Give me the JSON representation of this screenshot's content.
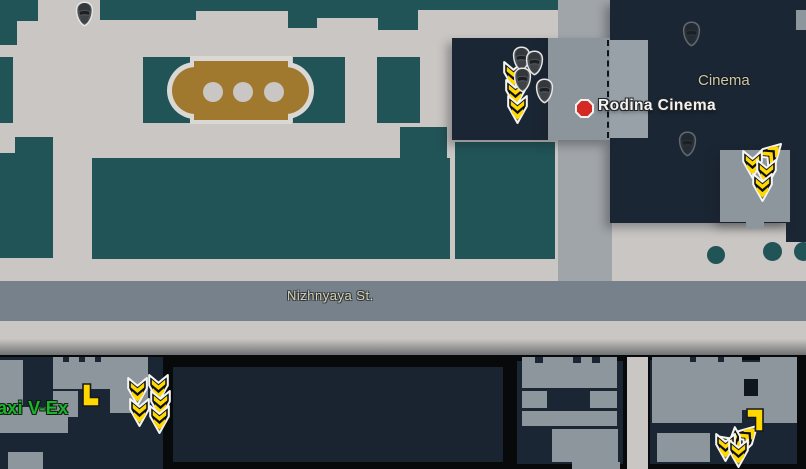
{
  "labels": {
    "district": "Cinema",
    "poi": "Rodina Cinema",
    "street": "Nizhnyaya St.",
    "extract": "Taxi V-Ex"
  },
  "colors": {
    "background": "#c9c6c3",
    "street": "#77818b",
    "road": "#a0a5a9",
    "building_teal": "#215457",
    "building_navy": "#1b2634",
    "building_room_gray": "#8d959d",
    "fountain_brown": "#a0792f",
    "poi_marker_red": "#d42a26",
    "extract_arrow_yellow": "#ffd800",
    "extract_text_green": "#1db32c",
    "label_khaki": "#cdc7a8"
  },
  "markers": {
    "scav_heads": [
      {
        "x": 74,
        "y": 1
      },
      {
        "x": 511,
        "y": 46
      },
      {
        "x": 524,
        "y": 50
      },
      {
        "x": 512,
        "y": 67
      },
      {
        "x": 534,
        "y": 78
      }
    ],
    "ghost_heads": [
      {
        "x": 681,
        "y": 21
      },
      {
        "x": 677,
        "y": 131
      }
    ],
    "extract_arrows": [
      {
        "x": 502,
        "y": 60,
        "rot": 0
      },
      {
        "x": 504,
        "y": 78,
        "rot": 0
      },
      {
        "x": 506,
        "y": 94,
        "rot": 0
      },
      {
        "x": 760,
        "y": 138,
        "rot": -135
      },
      {
        "x": 741,
        "y": 149,
        "rot": 0
      },
      {
        "x": 755,
        "y": 158,
        "rot": 0
      },
      {
        "x": 751,
        "y": 172,
        "rot": 0
      },
      {
        "x": 126,
        "y": 376,
        "rot": 0
      },
      {
        "x": 128,
        "y": 397,
        "rot": 0
      },
      {
        "x": 147,
        "y": 373,
        "rot": 0
      },
      {
        "x": 149,
        "y": 389,
        "rot": 0
      },
      {
        "x": 148,
        "y": 404,
        "rot": 0
      },
      {
        "x": 736,
        "y": 420,
        "rot": -135
      },
      {
        "x": 722,
        "y": 428,
        "rot": -30
      },
      {
        "x": 714,
        "y": 432,
        "rot": 0
      },
      {
        "x": 727,
        "y": 438,
        "rot": 0
      }
    ],
    "loot_markers": [
      {
        "x": 80,
        "y": 383,
        "rot": 0
      },
      {
        "x": 746,
        "y": 408,
        "rot": 180
      }
    ]
  }
}
